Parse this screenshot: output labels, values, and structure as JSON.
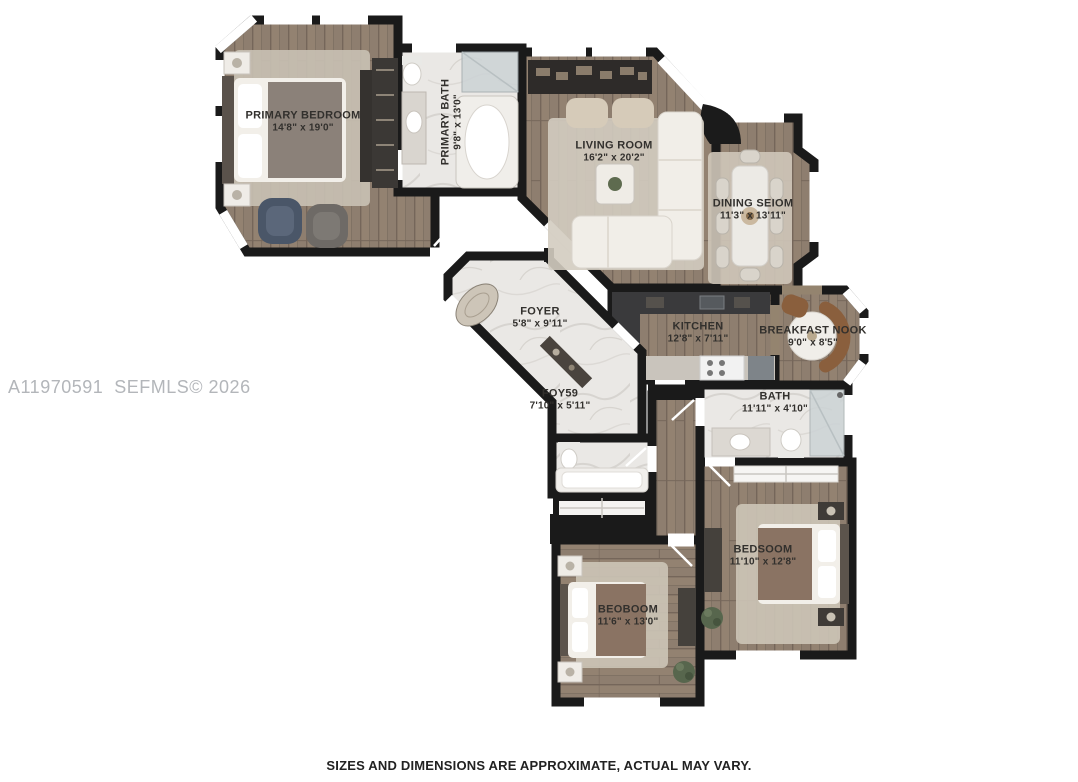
{
  "watermark": "A11970591  SEFMLS© 2026",
  "disclaimer": "SIZES AND DIMENSIONS ARE APPROXIMATE, ACTUAL MAY VARY.",
  "rooms": [
    {
      "id": "primary-bedroom",
      "name": "PRIMARY BEDROOM",
      "dims": "14'8\" x 19'0\""
    },
    {
      "id": "primary-bath",
      "name": "PRIMARY BATH",
      "dims": "9'8\" x 13'0\""
    },
    {
      "id": "living-room",
      "name": "LIVING ROOM",
      "dims": "16'2\" x 20'2\""
    },
    {
      "id": "dining-room",
      "name": "DINING SEIOM",
      "dims": "11'3\" x 13'11\""
    },
    {
      "id": "foyer",
      "name": "FOYER",
      "dims": "5'8\" x 9'11\""
    },
    {
      "id": "kitchen",
      "name": "KITCHEN",
      "dims": "12'8\" x 7'11\""
    },
    {
      "id": "breakfast-nook",
      "name": "BREAKFAST NOOK",
      "dims": "9'0\" x 8'5\""
    },
    {
      "id": "foyer-2",
      "name": "FOY59",
      "dims": "7'10\" x 5'11\""
    },
    {
      "id": "bath",
      "name": "BATH",
      "dims": "11'11\" x 4'10\""
    },
    {
      "id": "bedroom-2",
      "name": "BEDSOOM",
      "dims": "11'10\" x 12'8\""
    },
    {
      "id": "bedroom-3",
      "name": "BEOBOOM",
      "dims": "11'6\" x 13'0\""
    }
  ],
  "colors": {
    "background": "#ffffff",
    "walls": "#1a1a1a",
    "wood_floor": "#8e7e6f",
    "marble_floor": "#eae8e5",
    "rug": "#cdc5b7",
    "dark_furniture": "#45413c",
    "blanket": "#8a7363",
    "bench_leather": "#8a5f3d",
    "label_text": "#32302d",
    "watermark_text": "#b3b6ba",
    "disclaimer_text": "#222222"
  }
}
